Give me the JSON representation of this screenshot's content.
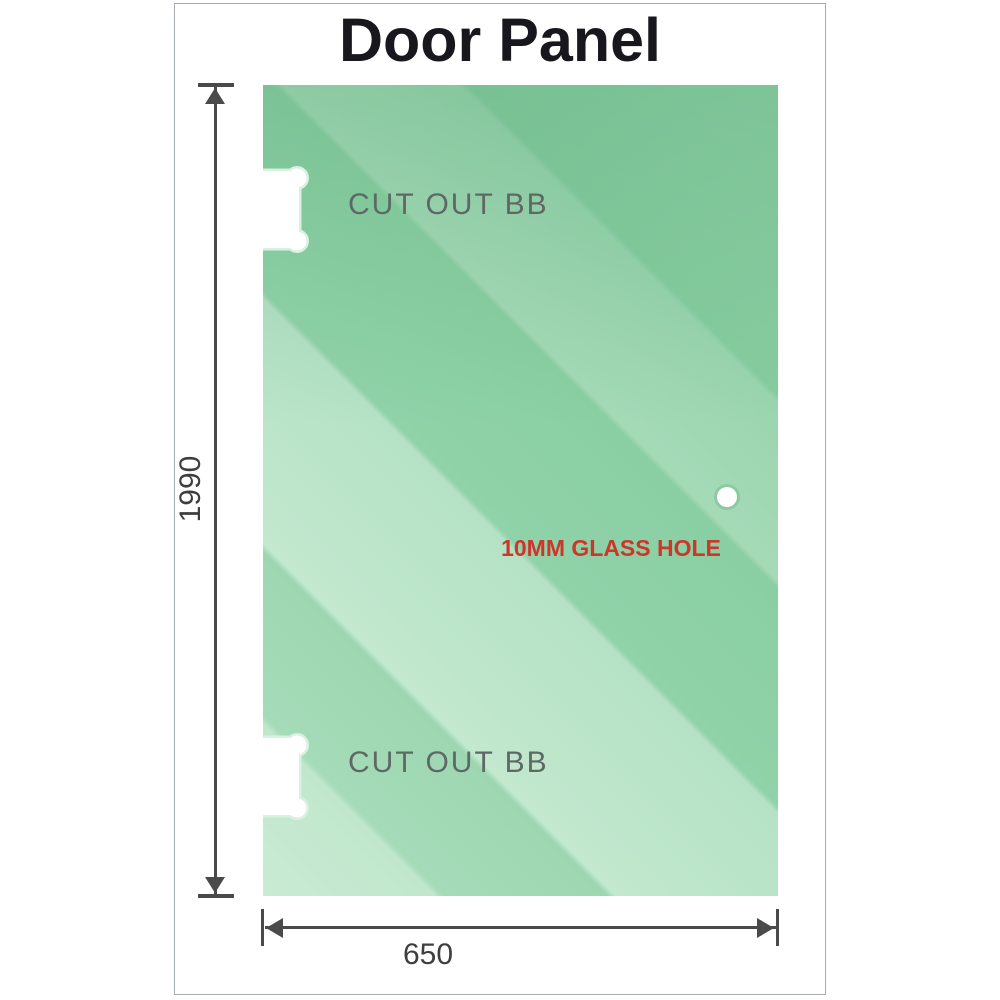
{
  "title": "Door Panel",
  "panel": {
    "cutout_top_label": "CUT OUT BB",
    "cutout_bottom_label": "CUT OUT BB",
    "glass_hole_label": "10MM GLASS HOLE"
  },
  "dimensions": {
    "height_value": "1990",
    "width_value": "650"
  },
  "icons": {
    "cutout_top": "hinge-cutout-icon",
    "cutout_bottom": "hinge-cutout-icon",
    "glass_hole": "glass-hole-icon"
  },
  "colors": {
    "glass_green_light": "#c9ebd4",
    "glass_green_mid": "#9dd7b2",
    "glass_green_dark": "#86cc9f",
    "cutout_ring_green": "#d8f1e1",
    "dimension_line_gray": "#4a4a4a",
    "dimension_text_gray": "#3e3e3e",
    "cutout_label_gray": "#5e6965",
    "hole_label_red": "#cc372b",
    "frame_border_gray": "#a6acb0",
    "title_color": "#17171d"
  }
}
